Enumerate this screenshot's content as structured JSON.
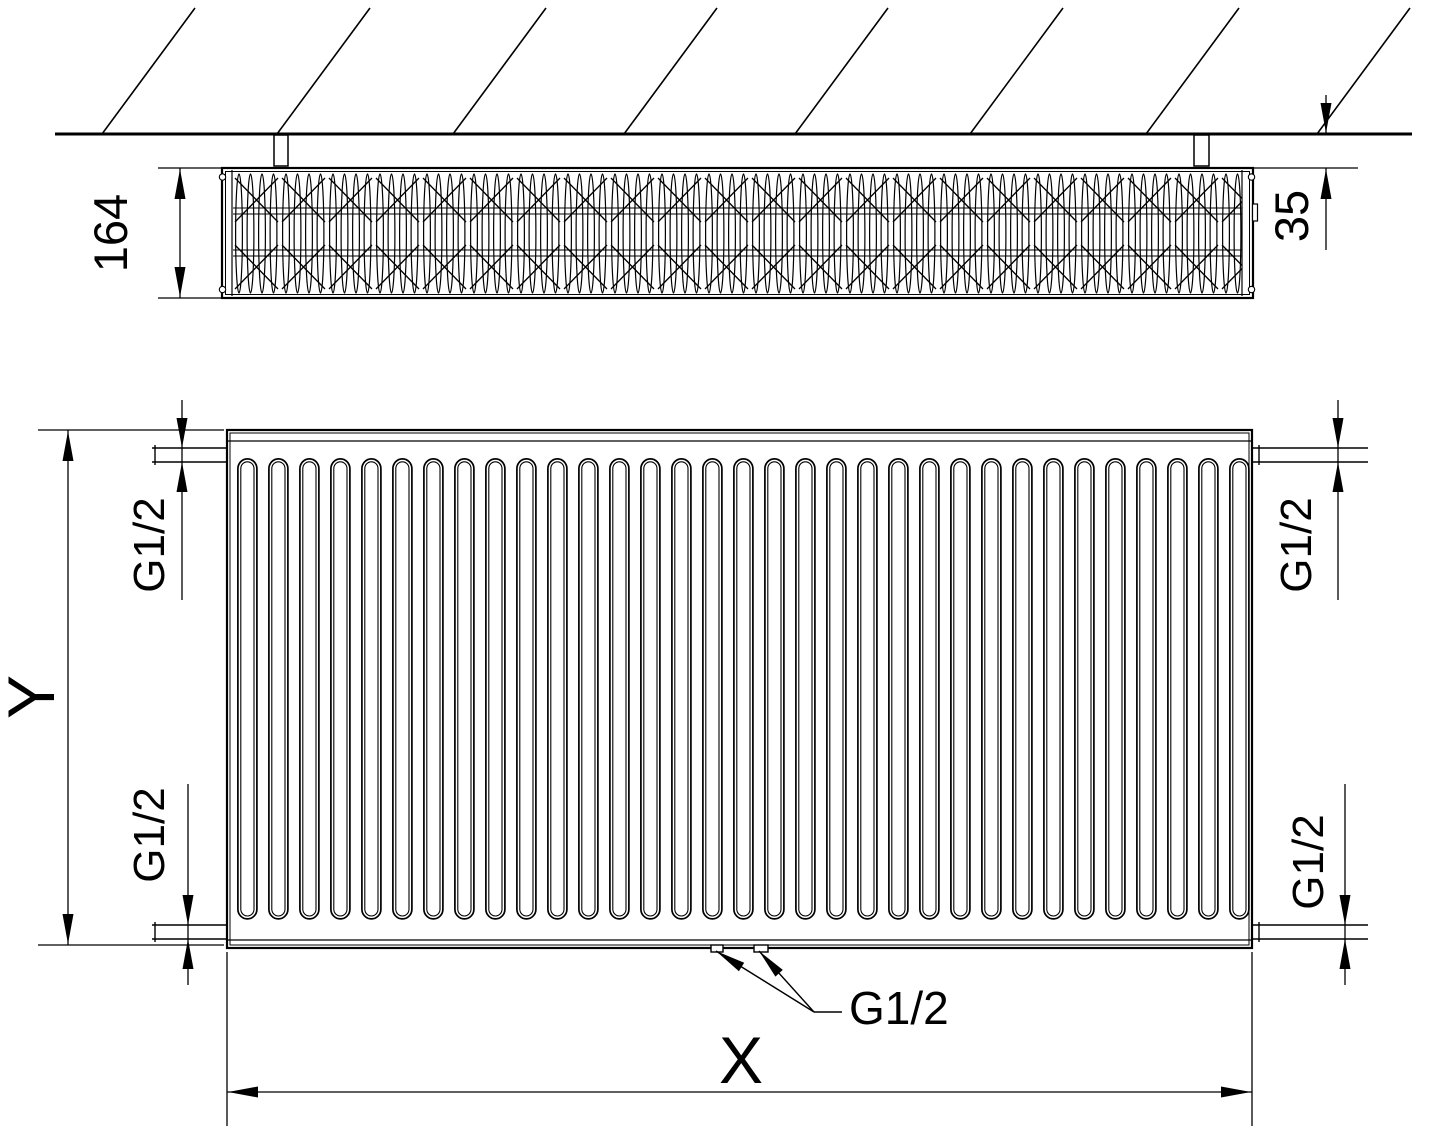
{
  "drawing": {
    "type": "radiator-technical-drawing",
    "top_view": {
      "depth_label": "164",
      "wall_distance_label": "35"
    },
    "front_view": {
      "height_label": "Y",
      "width_label": "X",
      "connections": {
        "top_left": "G1/2",
        "top_right": "G1/2",
        "bottom_left": "G1/2",
        "bottom_right": "G1/2",
        "bottom_center": "G1/2"
      }
    },
    "colors": {
      "line": "#000000",
      "background": "#ffffff"
    }
  }
}
